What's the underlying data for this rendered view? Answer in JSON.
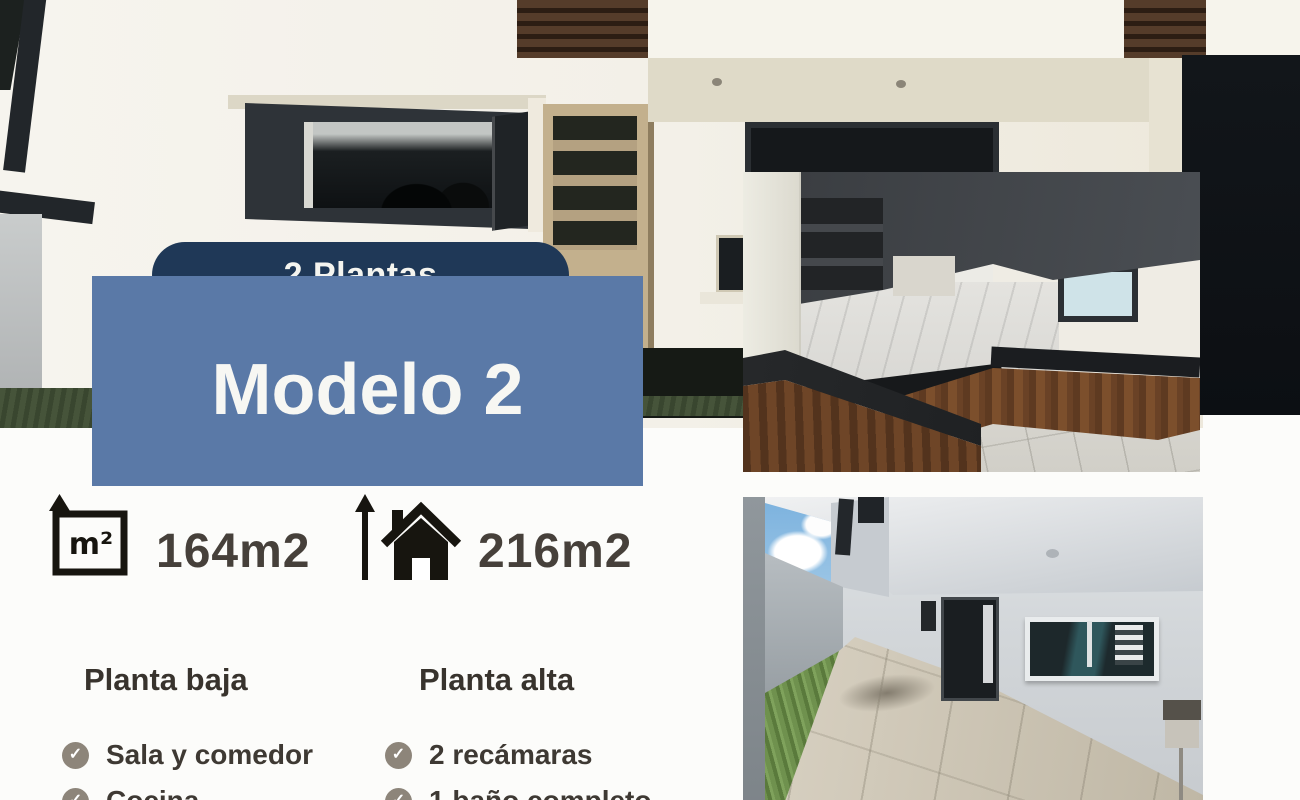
{
  "badge": {
    "label": "2 Plantas"
  },
  "title": {
    "text": "Modelo 2"
  },
  "metrics": {
    "land_area": {
      "icon": "square-meters-icon",
      "value": "164m2"
    },
    "built_area": {
      "icon": "house-up-arrow-icon",
      "value": "216m2"
    }
  },
  "floors": {
    "ground": {
      "header": "Planta baja",
      "items": [
        "Sala y comedor",
        "Cocina"
      ]
    },
    "upper": {
      "header": "Planta alta",
      "items": [
        "2 recámaras",
        "1 baño completo"
      ]
    }
  },
  "photos": {
    "background": "house-exterior-facade",
    "inset_top": "kitchen-interior",
    "inset_bottom": "backyard-patio"
  },
  "colors": {
    "badge_bg": "#1f3857",
    "panel_bg": "#5a79a7",
    "heading_text": "#38332d",
    "body_text": "#3e3933",
    "metric_text": "#46403a",
    "check_circle": "#8d857a",
    "canvas_bg": "#fcfcfa"
  },
  "glyphs": {
    "check": "✓"
  }
}
